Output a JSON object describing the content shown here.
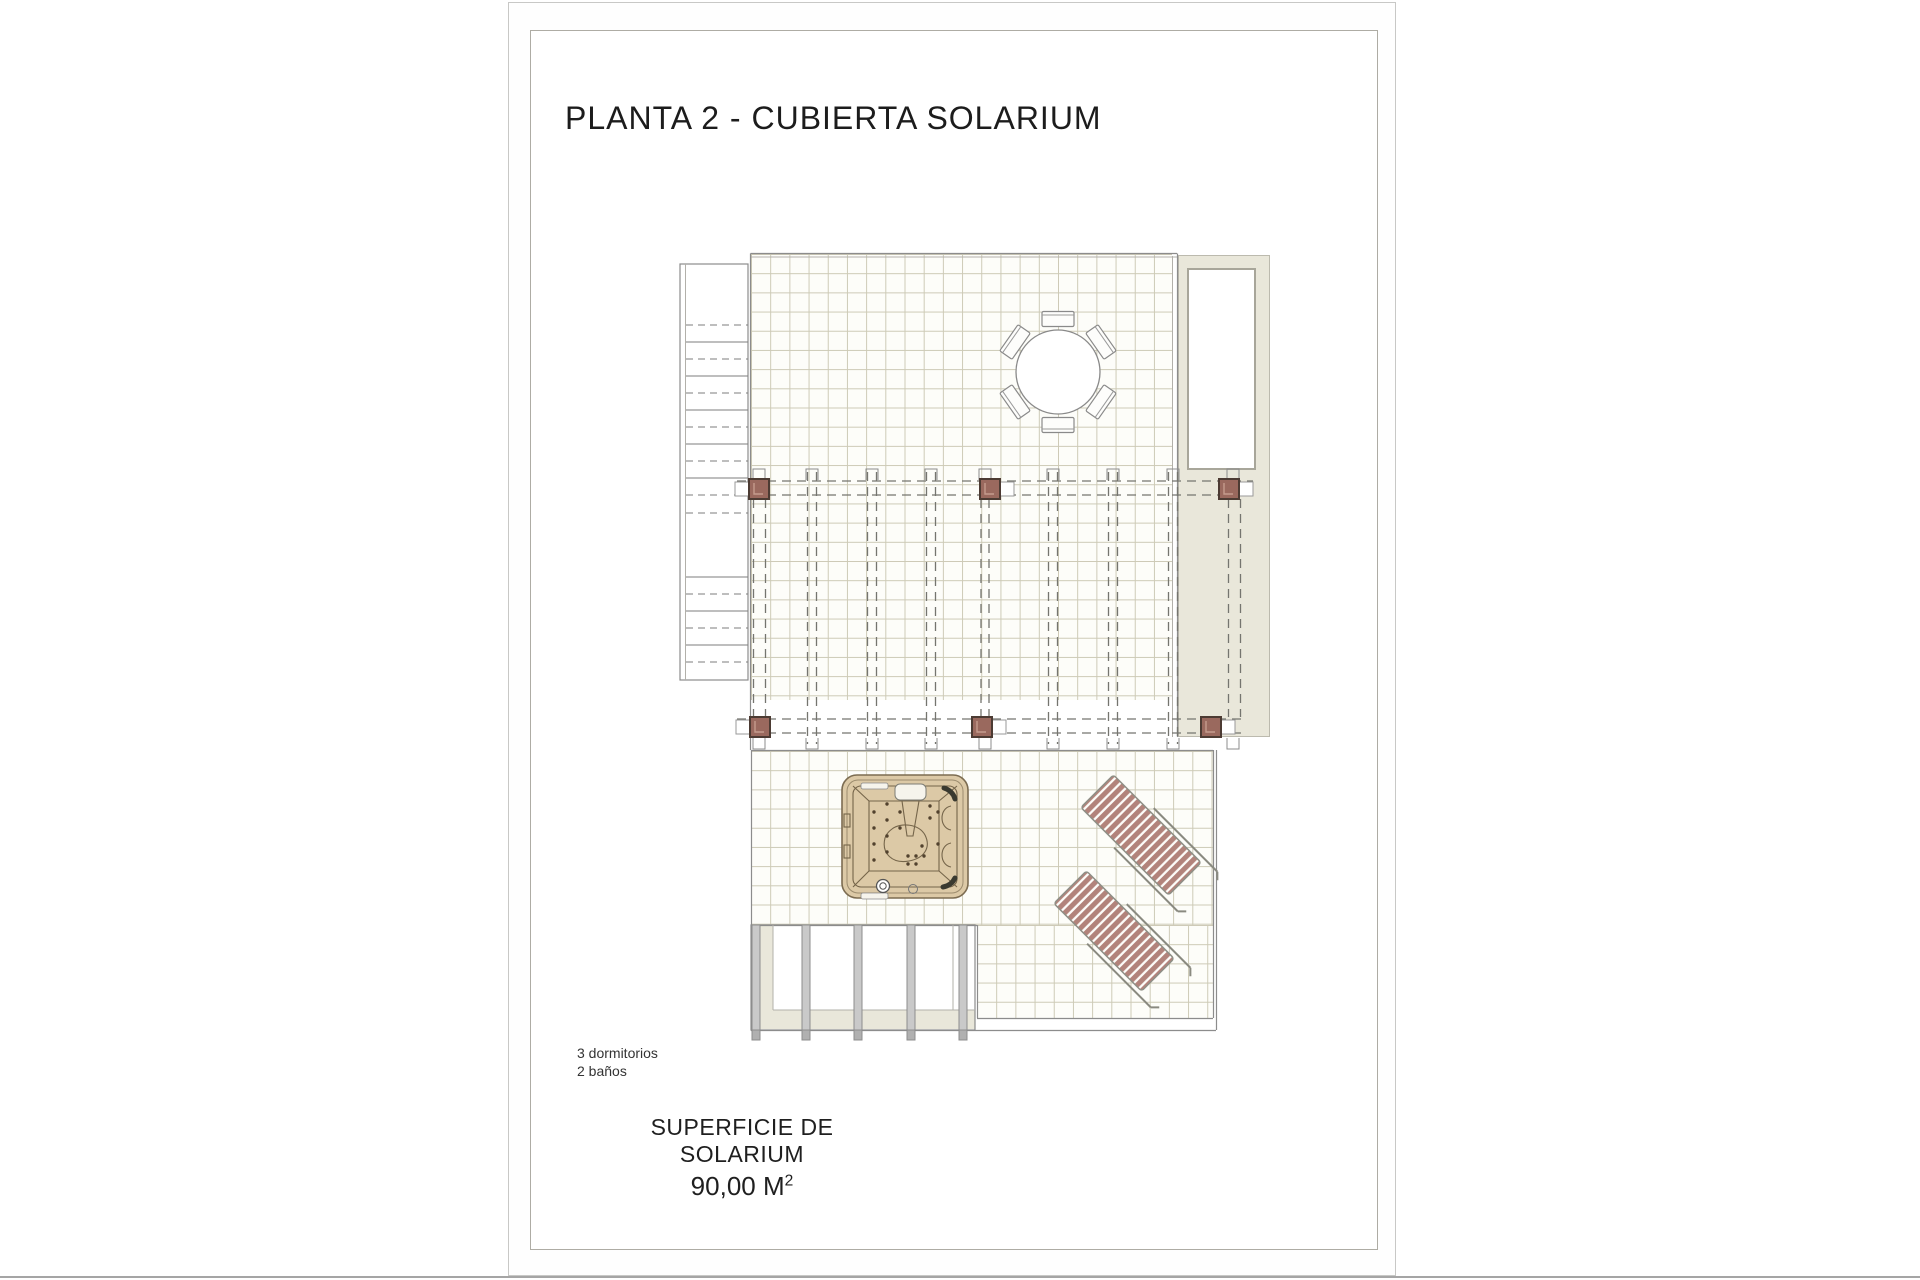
{
  "page": {
    "title": "PLANTA 2 - CUBIERTA SOLARIUM",
    "notes": {
      "line1": "3 dormitorios",
      "line2": "2 baños"
    },
    "surface": {
      "label": "SUPERFICIE DE SOLARIUM",
      "value": "90,00 M",
      "superscript": "2"
    }
  },
  "colors": {
    "post_brown": "#9a695e",
    "post_brown_border": "#4c3b33",
    "lounger_stripe": "#b2837b",
    "jacuzzi_shell": "#dcc9a6",
    "jacuzzi_line": "#75654a",
    "roof_cream": "#e9e7da",
    "grid_line": "#cdcab6",
    "ink": "#1c1c1c"
  }
}
